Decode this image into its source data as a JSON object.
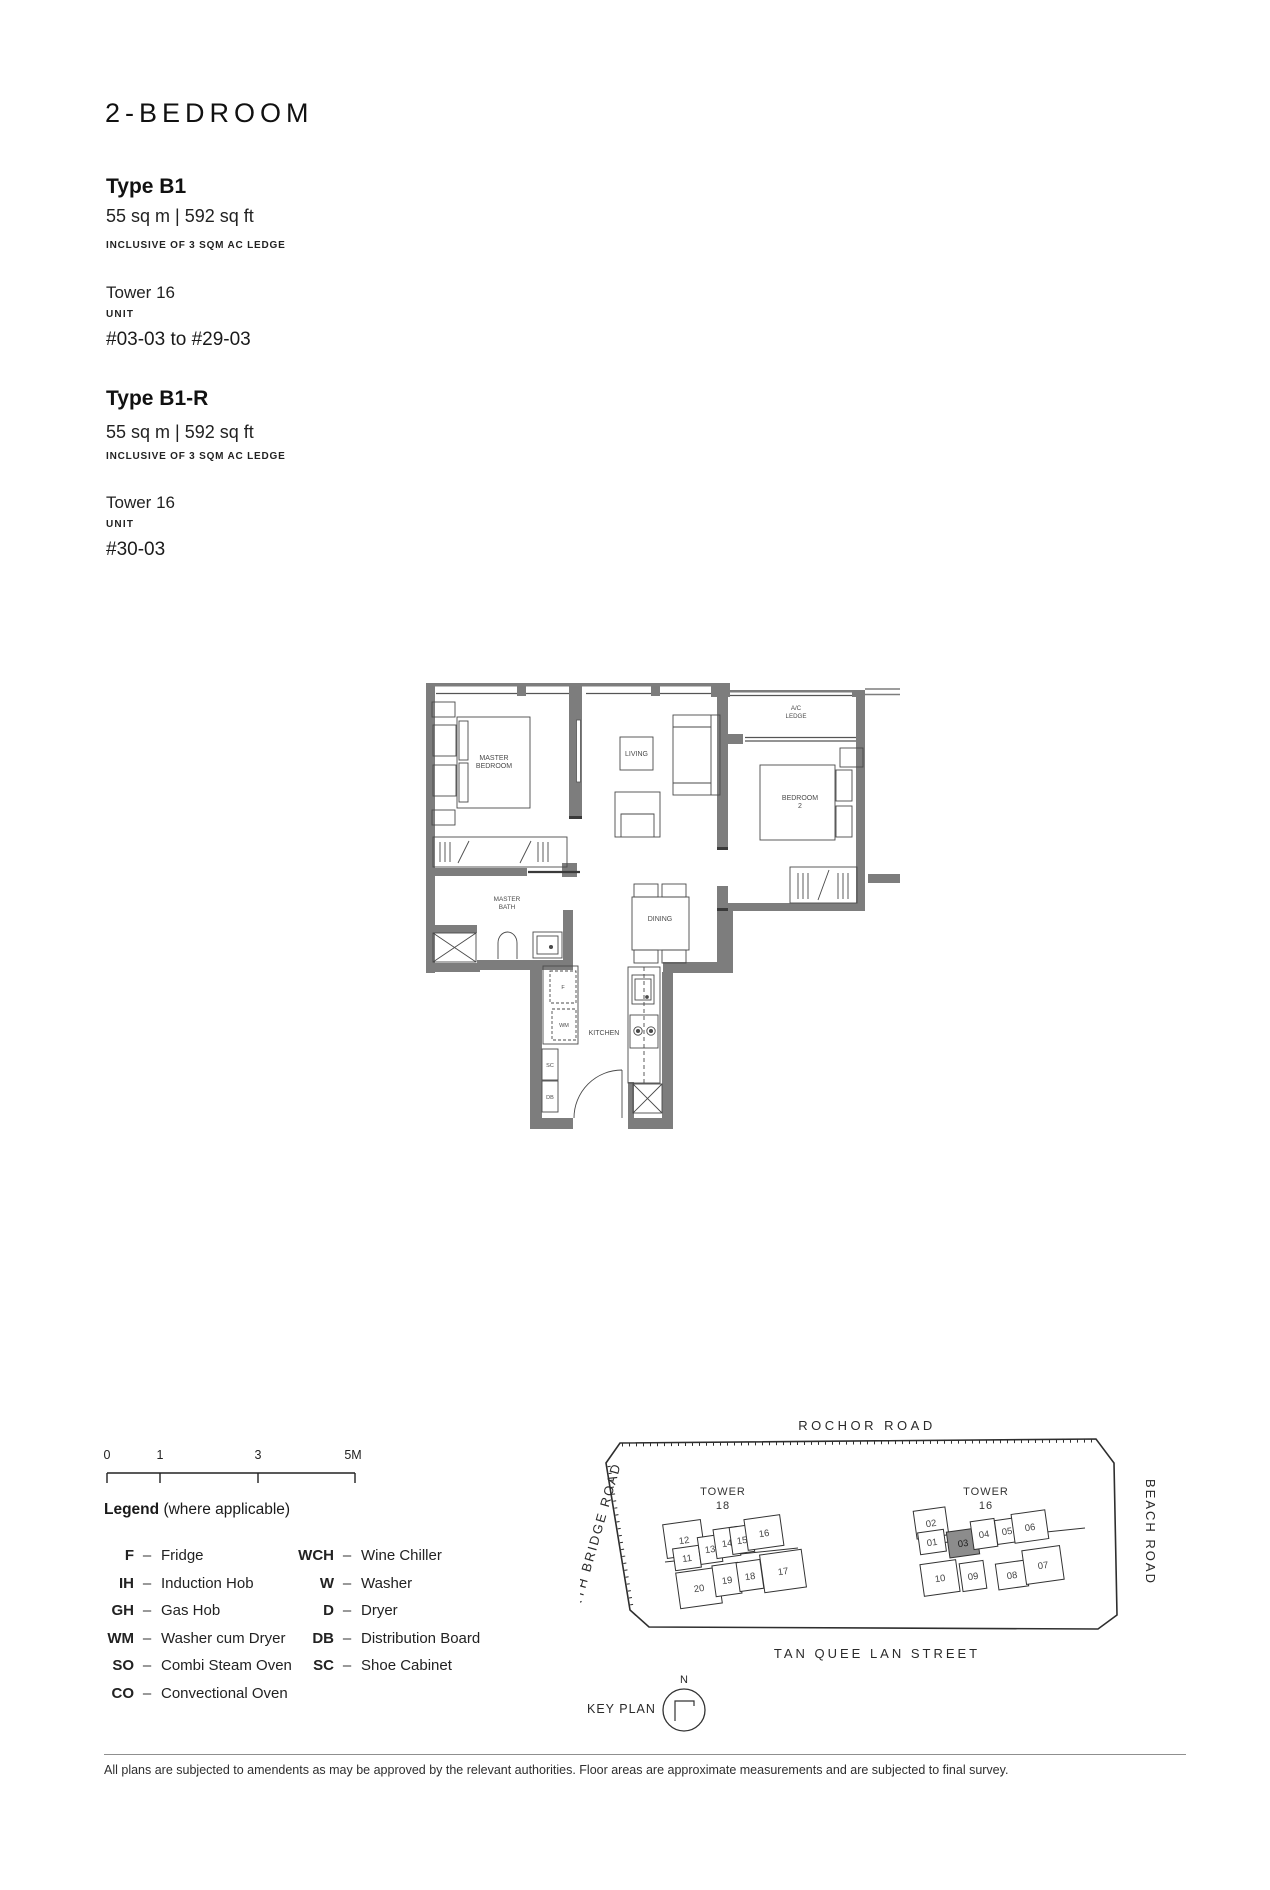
{
  "header": {
    "title": "2-BEDROOM",
    "types": [
      {
        "name": "Type B1",
        "area": "55 sq m | 592 sq ft",
        "inclusive": "INCLUSIVE OF 3 SQM AC LEDGE",
        "tower": "Tower 16",
        "unit_label": "UNIT",
        "units": "#03-03 to #29-03"
      },
      {
        "name": "Type B1-R",
        "area": "55 sq m | 592 sq ft",
        "inclusive": "INCLUSIVE OF 3 SQM AC LEDGE",
        "tower": "Tower 16",
        "unit_label": "UNIT",
        "units": "#30-03"
      }
    ]
  },
  "floorplan": {
    "rooms": {
      "master_bedroom": [
        "MASTER",
        "BEDROOM"
      ],
      "living": "LIVING",
      "ac_ledge": [
        "A/C",
        "LEDGE"
      ],
      "bedroom2": [
        "BEDROOM",
        "2"
      ],
      "master_bath": [
        "MASTER",
        "BATH"
      ],
      "dining": "DINING",
      "kitchen": "KITCHEN"
    },
    "fixtures": {
      "fridge": "F",
      "washer_cum_dryer": "WM",
      "shoe_cabinet": "SC",
      "distribution_board": "DB"
    }
  },
  "scalebar": {
    "ticks": [
      "0",
      "1",
      "3",
      "5M"
    ]
  },
  "legend": {
    "title": "Legend",
    "subtitle": "(where applicable)",
    "dash": "–",
    "col1": [
      [
        "F",
        "Fridge"
      ],
      [
        "IH",
        "Induction Hob"
      ],
      [
        "GH",
        "Gas Hob"
      ],
      [
        "WM",
        "Washer cum Dryer"
      ],
      [
        "SO",
        "Combi Steam Oven"
      ],
      [
        "CO",
        "Convectional Oven"
      ]
    ],
    "col2": [
      [
        "WCH",
        "Wine Chiller"
      ],
      [
        "W",
        "Washer"
      ],
      [
        "D",
        "Dryer"
      ],
      [
        "DB",
        "Distribution Board"
      ],
      [
        "SC",
        "Shoe Cabinet"
      ]
    ]
  },
  "keyplan": {
    "label": "KEY PLAN",
    "north": "N",
    "roads": {
      "top": "ROCHOR ROAD",
      "left": "NORTH BRIDGE ROAD",
      "right": "BEACH ROAD",
      "bottom": "TAN QUEE LAN STREET"
    },
    "tower18": {
      "label": [
        "TOWER",
        "18"
      ],
      "units": [
        "12",
        "11",
        "13",
        "14",
        "15",
        "16",
        "20",
        "19",
        "18",
        "17"
      ]
    },
    "tower16": {
      "label": [
        "TOWER",
        "16"
      ],
      "units": [
        "02",
        "01",
        "03",
        "04",
        "05",
        "06",
        "10",
        "09",
        "08",
        "07"
      ],
      "highlighted": "03"
    }
  },
  "footer": {
    "disclaimer": "All plans are subjected to amendents as may be approved by the relevant authorities. Floor areas are approximate measurements and are subjected to final survey."
  },
  "colors": {
    "wall": "#7d7d7d",
    "line": "#3a3a3a",
    "highlight": "#8c8c8c"
  }
}
